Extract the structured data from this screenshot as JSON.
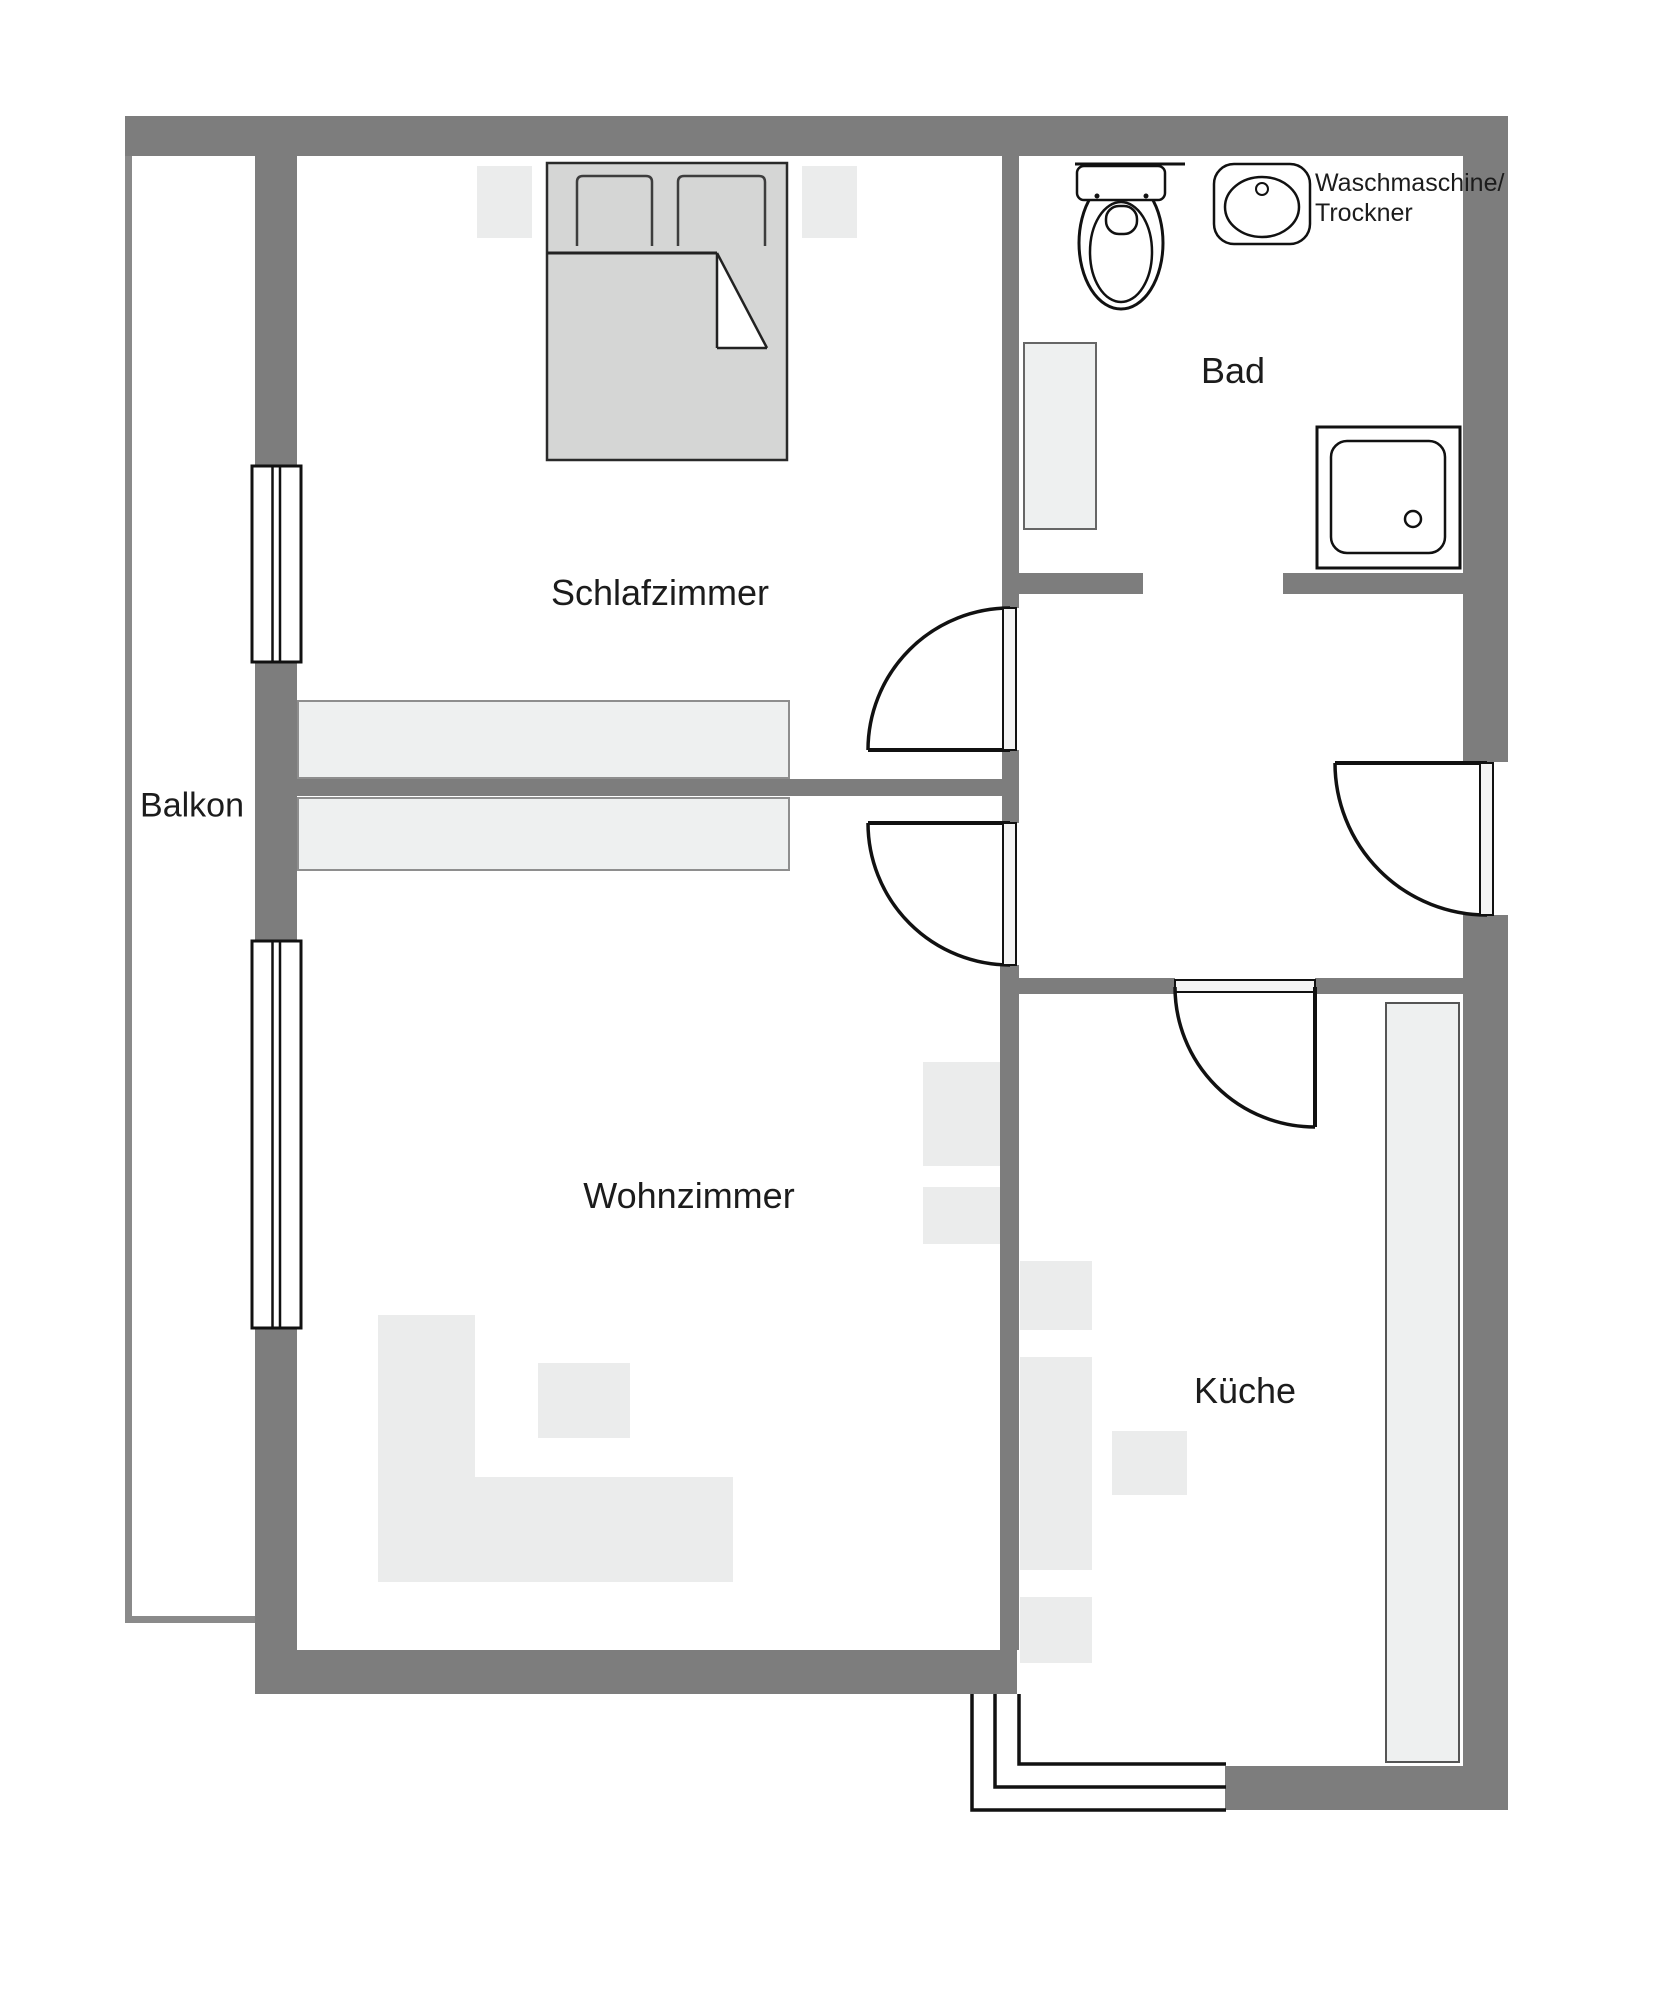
{
  "rooms": [
    {
      "id": "schlafzimmer",
      "label": "Schlafzimmer"
    },
    {
      "id": "bad",
      "label": "Bad"
    },
    {
      "id": "balkon",
      "label": "Balkon"
    },
    {
      "id": "wohnzimmer",
      "label": "Wohnzimmer"
    },
    {
      "id": "kueche",
      "label": "Küche"
    }
  ],
  "annotation": {
    "washer_dryer_line1": "Waschmaschine/",
    "washer_dryer_line2": "Trockner"
  },
  "fixtures": {
    "toilet": "toilet-icon",
    "washbasin": "washbasin-icon",
    "shower": "shower-icon",
    "bed": "bed-icon",
    "door": "door-swing-icon",
    "window": "window-icon",
    "steps": "entry-steps-icon"
  },
  "colors": {
    "wall": "#7d7d7d",
    "balcony": "#8a8a8a",
    "furn": "#ebecec",
    "furn2": "#eef0f0",
    "bed": "#d5d6d5",
    "ink": "#1c1c1c",
    "bg": "#ffffff"
  }
}
